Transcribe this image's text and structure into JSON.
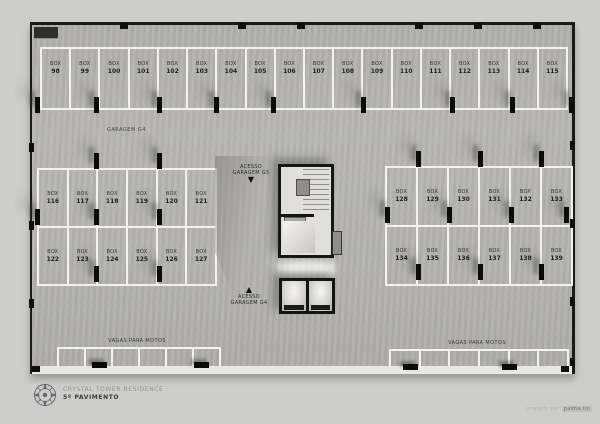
{
  "colors": {
    "page_bg": "#cdcdcb",
    "slab": "#b4b3ae",
    "parking_line": "#f3f2ef",
    "wall": "#1a1a17",
    "column": "#0b0b09"
  },
  "plan": {
    "garage_label": "GARAGEM G4",
    "stall_prefix": "BOX",
    "top_row_numbers": [
      98,
      99,
      100,
      101,
      102,
      103,
      104,
      105,
      106,
      107,
      108,
      109,
      110,
      111,
      112,
      113,
      114,
      115
    ],
    "left_block_rows": [
      [
        116,
        117,
        118,
        119,
        120,
        121
      ],
      [
        122,
        123,
        124,
        125,
        126,
        127
      ]
    ],
    "right_block_rows": [
      [
        128,
        129,
        130,
        131,
        132,
        133
      ],
      [
        134,
        135,
        136,
        137,
        138,
        139
      ]
    ],
    "access_down": {
      "line1": "ACESSO",
      "line2": "GARAGEM G5",
      "arrow": "▼"
    },
    "access_up": {
      "arrow": "▲",
      "line1": "ACESSO",
      "line2": "GARAGEM G4"
    },
    "moto_left_label": "VAGAS PARA MOTOS",
    "moto_right_label": "VAGAS PARA MOTOS"
  },
  "footer": {
    "project": "CRYSTAL TOWER RESIDENCE",
    "floor": "5º PAVIMENTO"
  },
  "credit": {
    "prefix": "imagem por",
    "name": "palma.rio"
  }
}
